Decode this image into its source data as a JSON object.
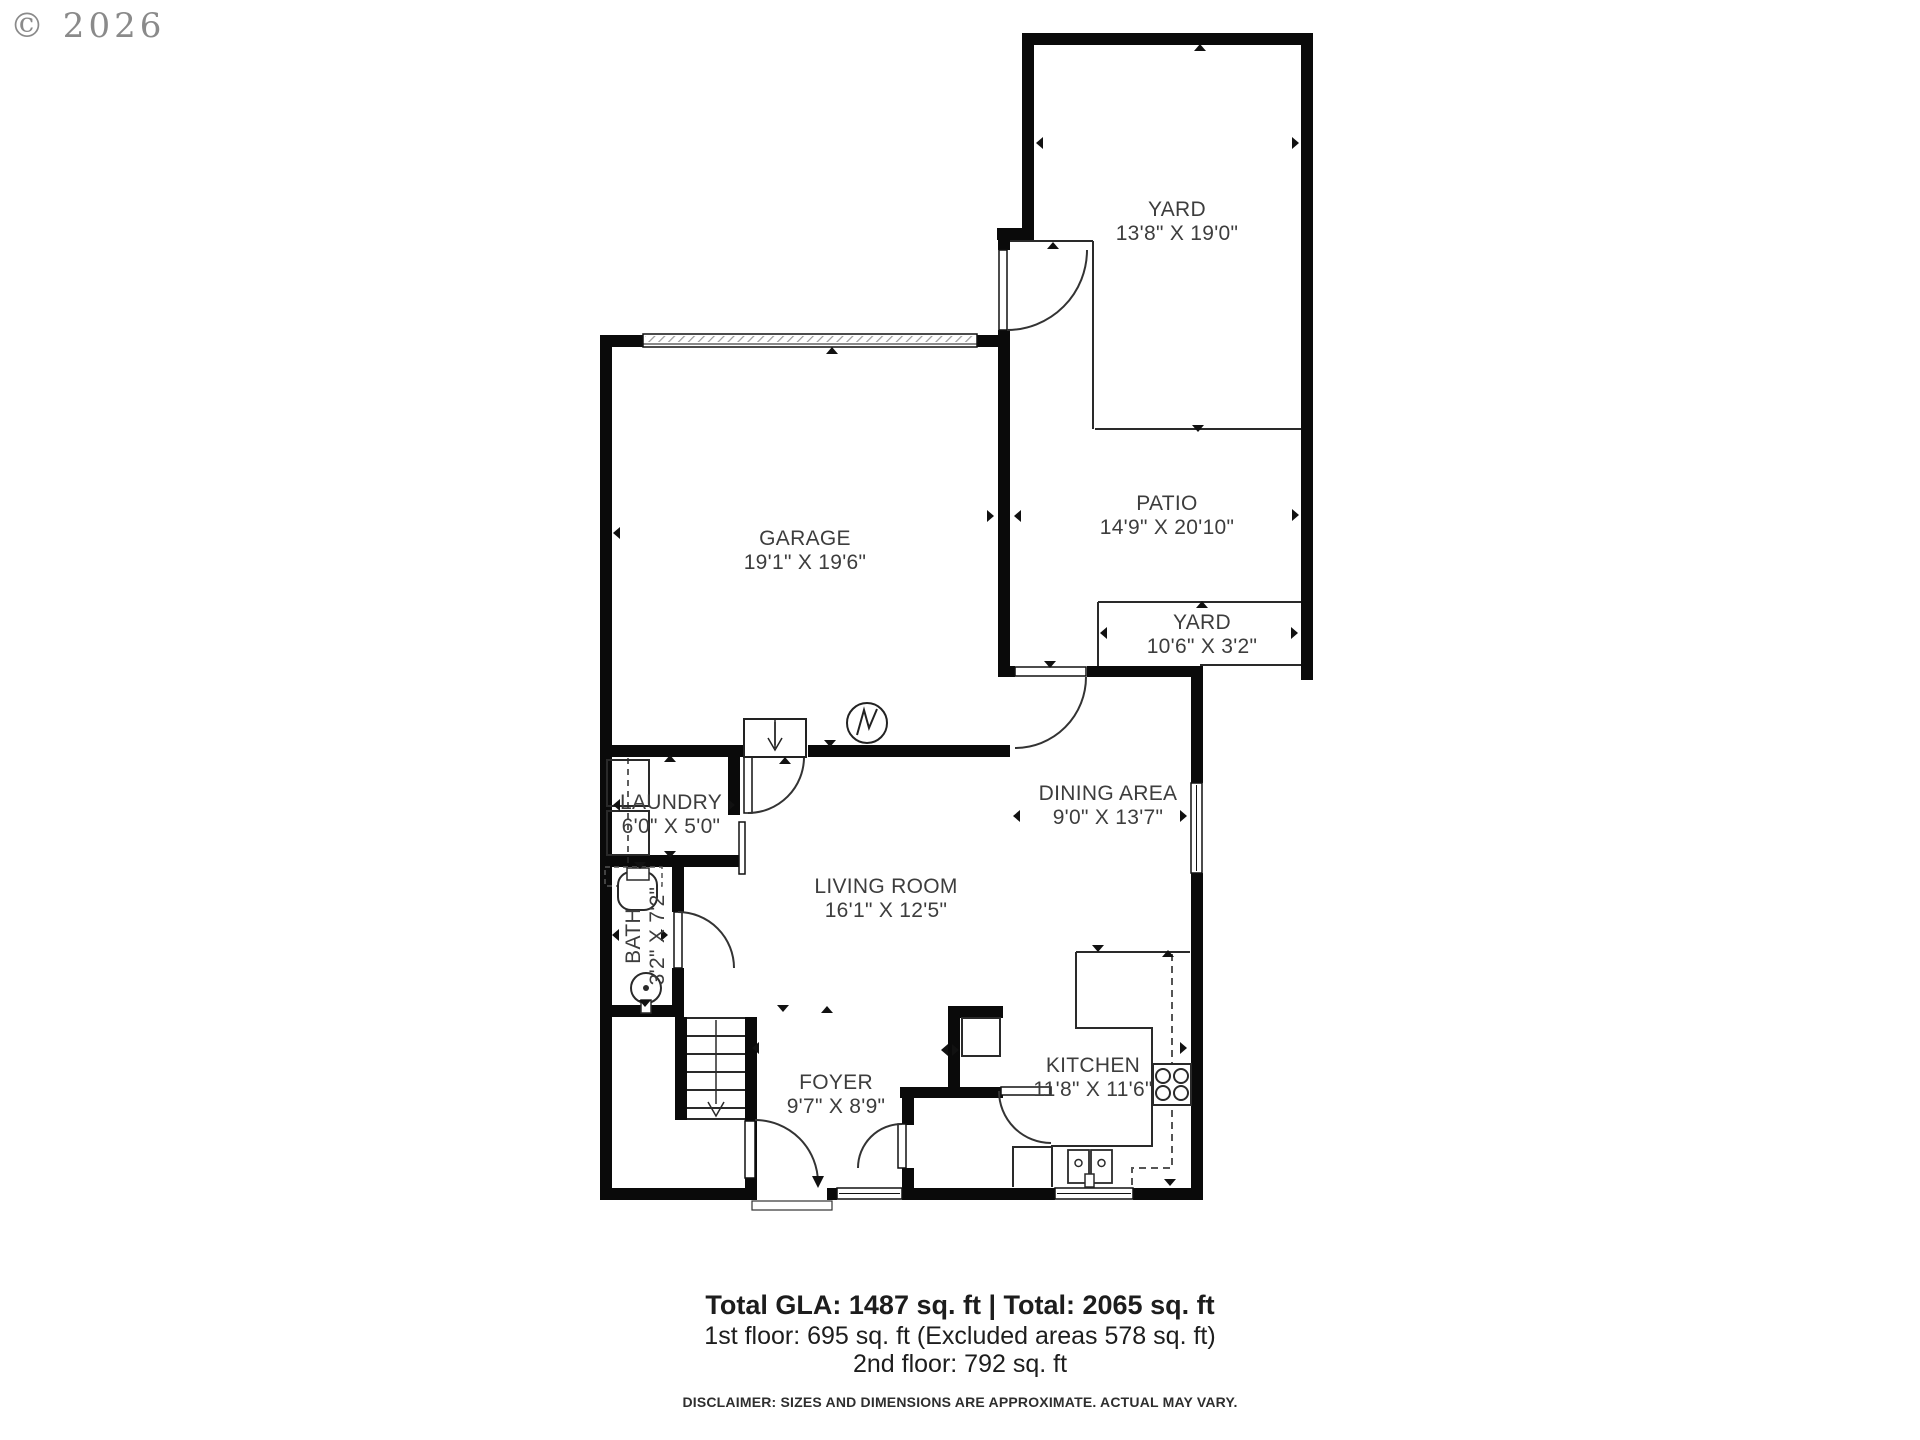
{
  "watermark": "© 2026",
  "rooms": [
    {
      "name": "YARD",
      "dims": "13'8\" X 19'0\""
    },
    {
      "name": "PATIO",
      "dims": "14'9\" X 20'10\""
    },
    {
      "name": "YARD",
      "dims": "10'6\" X 3'2\""
    },
    {
      "name": "GARAGE",
      "dims": "19'1\" X 19'6\""
    },
    {
      "name": "LAUNDRY",
      "dims": "6'0\" X 5'0\""
    },
    {
      "name": "BATH",
      "dims": "3'2\" X 7'2\""
    },
    {
      "name": "LIVING ROOM",
      "dims": "16'1\" X 12'5\""
    },
    {
      "name": "DINING AREA",
      "dims": "9'0\" X 13'7\""
    },
    {
      "name": "FOYER",
      "dims": "9'7\" X 8'9\""
    },
    {
      "name": "KITCHEN",
      "dims": "11'8\" X 11'6\""
    }
  ],
  "footer": {
    "line1": "Total GLA: 1487 sq. ft | Total: 2065 sq. ft",
    "line2": "1st floor: 695 sq. ft (Excluded areas 578 sq. ft)",
    "line3": "2nd floor: 792 sq. ft",
    "disclaimer": "DISCLAIMER: SIZES AND DIMENSIONS ARE APPROXIMATE. ACTUAL MAY VARY."
  }
}
